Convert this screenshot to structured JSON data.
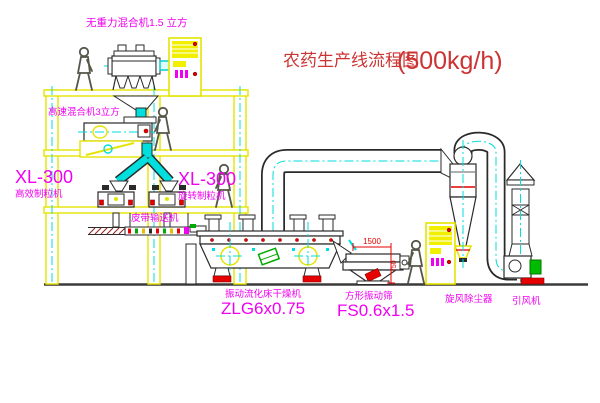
{
  "title": {
    "name": "农药生产线流程图",
    "capacity": "(500kg/h)"
  },
  "equipment_labels": {
    "gravity_mixer": "无重力混合机1.5 立方",
    "high_speed_mixer": "高速混合机3立方",
    "granulator_left_model": "XL-300",
    "granulator_left_name": "高效制粒机",
    "granulator_center_model": "XL-300",
    "granulator_center_name": "旋转制粒机",
    "belt_conveyor": "皮带输送机",
    "fluid_bed_dryer_name": "振动流化床干燥机",
    "fluid_bed_dryer_model": "ZLG6x0.75",
    "vibrating_screen_name": "方形振动筛",
    "vibrating_screen_model": "FS0.6x1.5",
    "cyclone_separator": "旋风除尘器",
    "induced_draft_fan": "引风机"
  },
  "dimensions": {
    "screen_length_mm": "1500",
    "screen_height_mm": "750"
  },
  "colors": {
    "label": "#f000f0",
    "title": "#cc3333",
    "structure": "#e4e400",
    "centerline": "#00dede",
    "dimension": "#e60000",
    "machine_outline": "#2a2a2a"
  }
}
